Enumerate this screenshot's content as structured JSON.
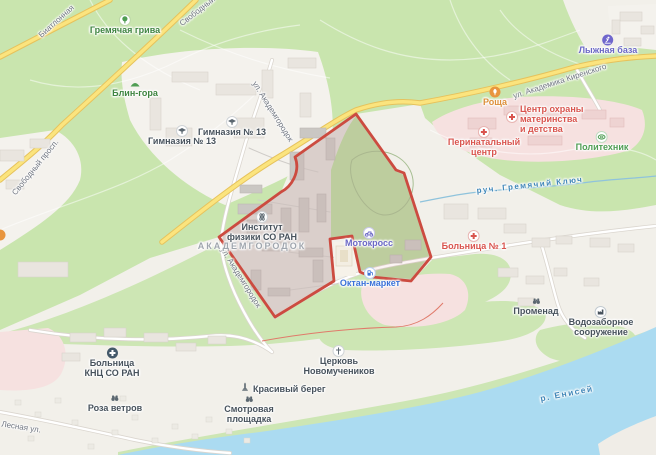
{
  "map": {
    "district_label": "АКАДЕМГОРОДОК",
    "colors": {
      "boundary_red": "#cc4b40",
      "medical_red": "#d9544e",
      "leisure_violet": "#6a67c5",
      "commerce_blue": "#3b72d8",
      "nature_green": "#3e8440",
      "sport_green": "#4f9d53",
      "poi_slate": "#47525c",
      "road_label_gray": "#6f7580",
      "water_blue": "#3f86b8",
      "food_orange": "#dd8f3a"
    },
    "roads": {
      "biathlonnaya": "Биатлонная",
      "svobodny": "Свободный",
      "svobodny_prospekt": "Свободный просп.",
      "akademgorodok_upper": "ул. Академгородок",
      "akademgorodok_lower": "ул. Академгородок",
      "kirenskogo": "ул. Академика Киренского",
      "lesnaya": "Лесная ул."
    },
    "water": {
      "river": "р. Енисей",
      "stream": "руч. Гремячий Ключ"
    },
    "pois": {
      "gremyachaya_griva": {
        "label": "Гремячая грива"
      },
      "blin_gora": {
        "label": "Блин-гора"
      },
      "gymnasium_13_a": {
        "label": "Гимназия № 13"
      },
      "gymnasium_13_b": {
        "label": "Гимназия № 13"
      },
      "institute_physics": {
        "line1": "Институт",
        "line2": "физики СО РАН"
      },
      "motocross": {
        "label": "Мотокросс"
      },
      "oktan_market": {
        "label": "Октан-маркет"
      },
      "roshcha": {
        "label": "Роща"
      },
      "lyzhnaya_baza": {
        "label": "Лыжная база"
      },
      "maternity_center": {
        "line1": "Центр охраны",
        "line2": "материнства",
        "line3": "и детства"
      },
      "perinatal_center": {
        "line1": "Перинатальный",
        "line2": "центр"
      },
      "politekhnik": {
        "label": "Политехник"
      },
      "bolnitsa_1": {
        "label": "Больница № 1"
      },
      "promenad": {
        "label": "Променад"
      },
      "vodozabor": {
        "line1": "Водозаборное",
        "line2": "сооружение"
      },
      "bolnitsa_knts": {
        "line1": "Больница",
        "line2": "КНЦ СО РАН"
      },
      "roza_vetrov": {
        "label": "Роза ветров"
      },
      "krasivy_bereg": {
        "label": "Красивый берег"
      },
      "smotrovaya": {
        "line1": "Смотровая",
        "line2": "площадка"
      },
      "tserkov": {
        "line1": "Церковь",
        "line2": "Новомучеников"
      }
    }
  }
}
